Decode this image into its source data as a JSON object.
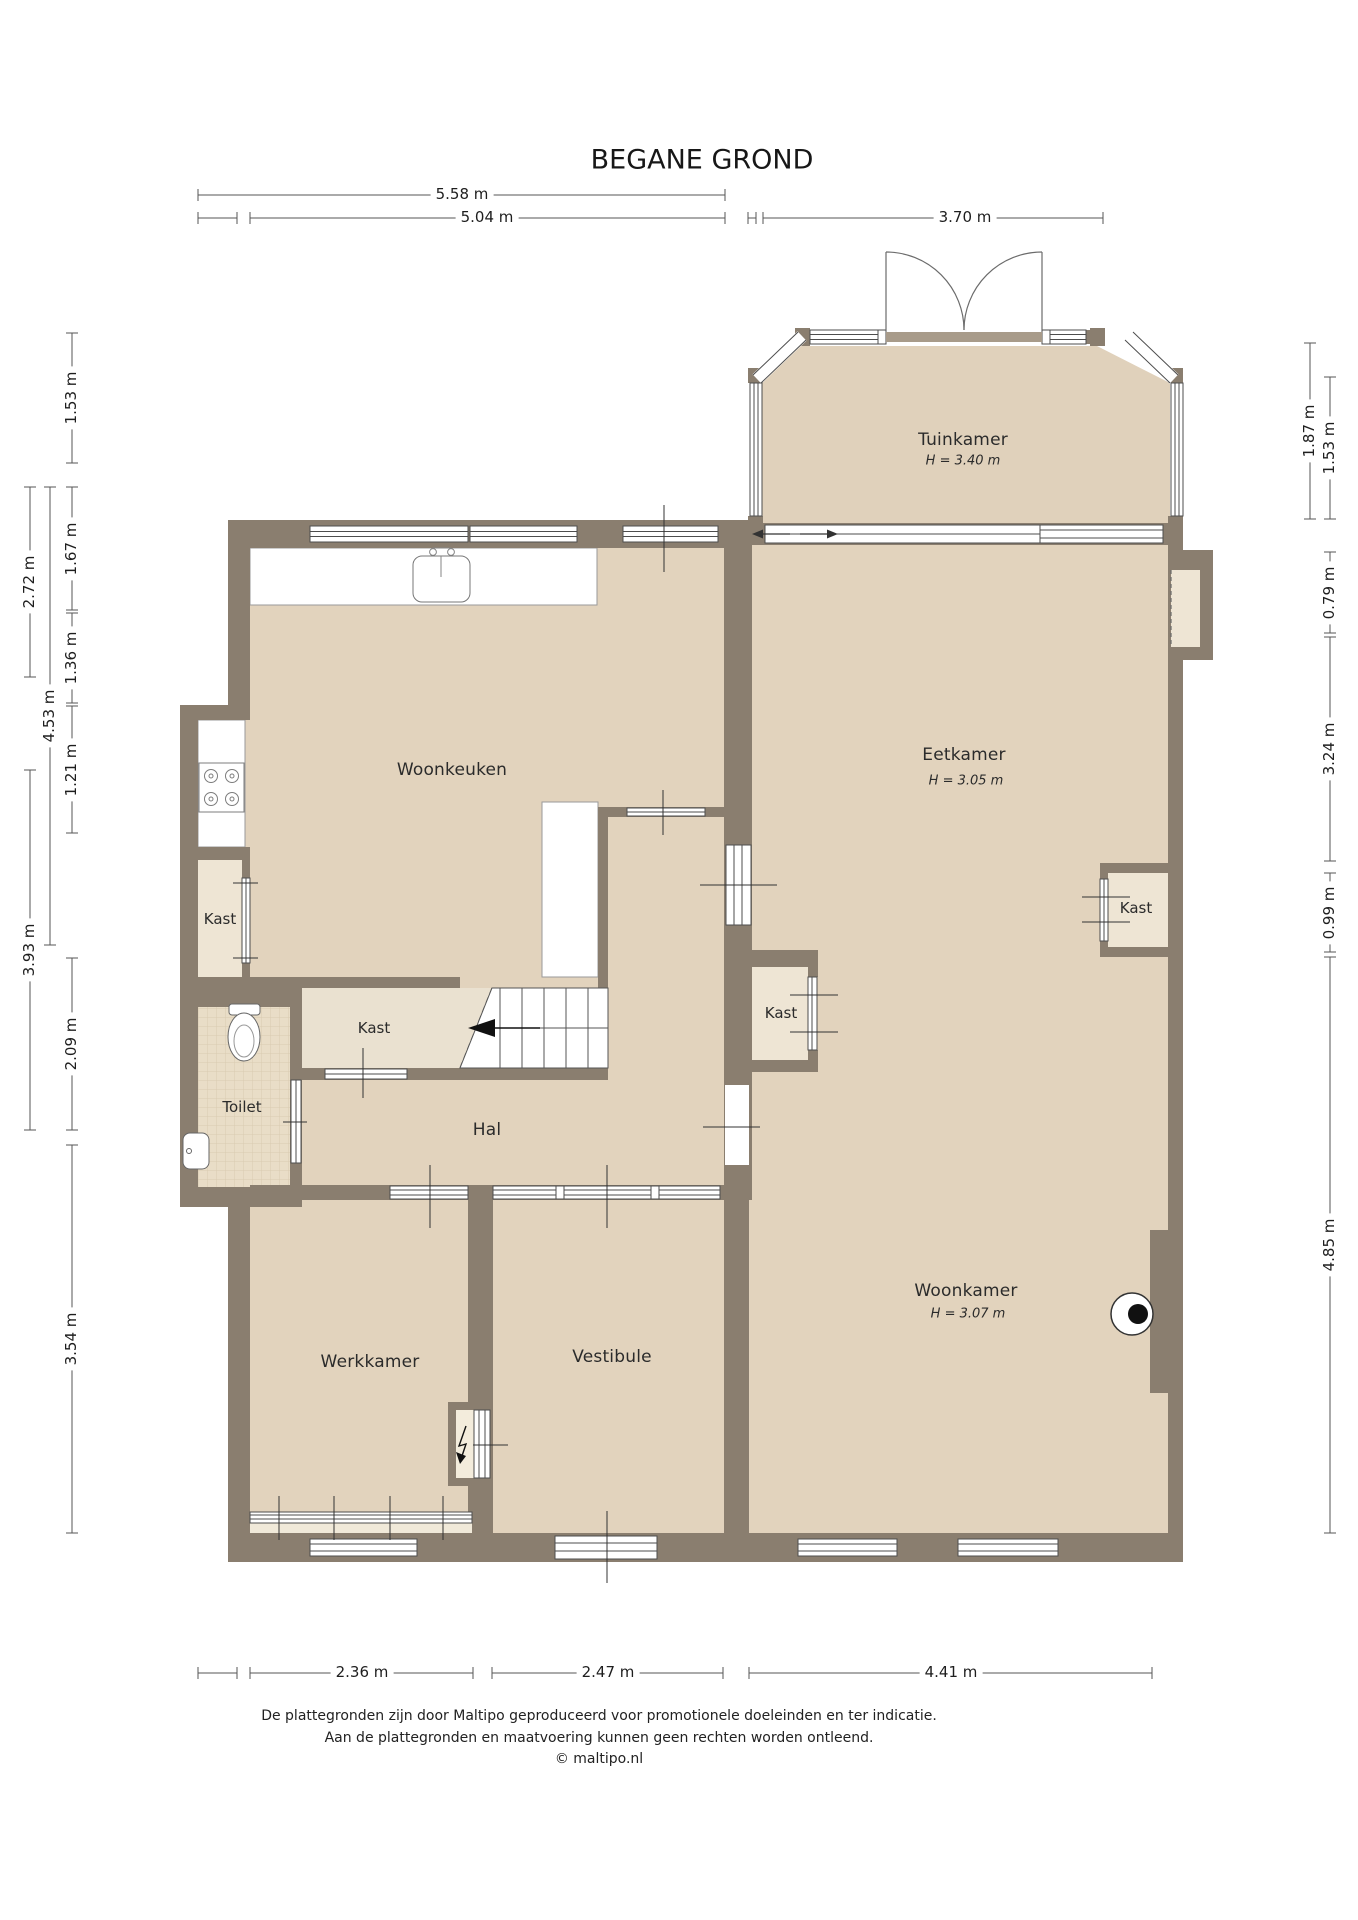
{
  "title": "BEGANE GROND",
  "rooms": {
    "tuinkamer": {
      "name": "Tuinkamer",
      "height": "H = 3.40 m"
    },
    "woonkeuken": {
      "name": "Woonkeuken"
    },
    "eetkamer": {
      "name": "Eetkamer",
      "height": "H = 3.05 m"
    },
    "woonkamer": {
      "name": "Woonkamer",
      "height": "H = 3.07 m"
    },
    "hal": {
      "name": "Hal"
    },
    "toilet": {
      "name": "Toilet"
    },
    "werkkamer": {
      "name": "Werkkamer"
    },
    "vestibule": {
      "name": "Vestibule"
    },
    "kast_keuken": {
      "name": "Kast"
    },
    "kast_hal": {
      "name": "Kast"
    },
    "kast_eetkamer_links": {
      "name": "Kast"
    },
    "kast_eetkamer_rechts": {
      "name": "Kast"
    }
  },
  "dimensions": {
    "top": [
      {
        "label": "5.58 m"
      },
      {
        "label": "5.04 m"
      },
      {
        "label": "3.70 m"
      }
    ],
    "left": [
      {
        "label": "1.53 m"
      },
      {
        "label": "1.67 m"
      },
      {
        "label": "1.36 m"
      },
      {
        "label": "1.21 m"
      },
      {
        "label": "2.09 m"
      },
      {
        "label": "3.54 m"
      },
      {
        "label": "4.53 m"
      },
      {
        "label": "2.72 m"
      },
      {
        "label": "3.93 m"
      }
    ],
    "right": [
      {
        "label": "1.87 m"
      },
      {
        "label": "1.53 m"
      },
      {
        "label": "0.79 m"
      },
      {
        "label": "3.24 m"
      },
      {
        "label": "0.99 m"
      },
      {
        "label": "4.85 m"
      }
    ],
    "bottom": [
      {
        "label": "2.36 m"
      },
      {
        "label": "2.47 m"
      },
      {
        "label": "4.41 m"
      }
    ]
  },
  "footer": {
    "line1": "De plattegronden zijn door Maltipo geproduceerd voor promotionele doeleinden en ter indicatie.",
    "line2": "Aan de plattegronden en maatvoering kunnen geen rechten worden ontleend.",
    "line3": "© maltipo.nl"
  },
  "colors": {
    "wall": "#8a7e6f",
    "floor": "#e2d3bd",
    "closet_floor": "#eee5d4",
    "tile_line": "#d9cab0",
    "dim_line": "#555555"
  }
}
